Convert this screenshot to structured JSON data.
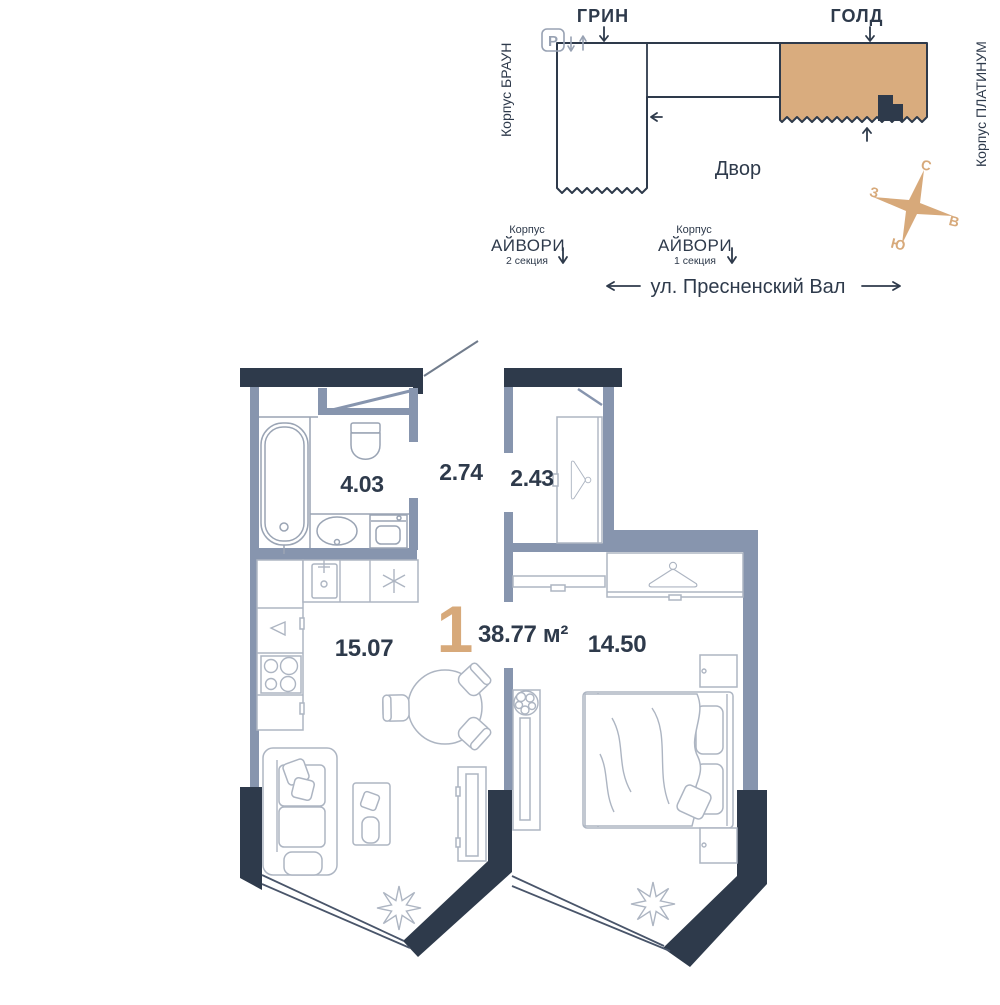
{
  "theme": {
    "wall_dark": "#2E3A4B",
    "wall_light": "#8795AE",
    "accent": "#D7A97A",
    "gold_fill": "#D9AC7E",
    "line_light": "#9AA4B4",
    "furniture": "#ADB5C2",
    "outline_gray": "#98A2B3",
    "glazing": "#49556A",
    "leader": "#717C8C"
  },
  "site_plan": {
    "labels": {
      "green": "ГРИН",
      "gold": "ГОЛД",
      "brown": "Корпус БРАУН",
      "platinum": "Корпус ПЛАТИНУМ",
      "ivory2_korpus": "Корпус",
      "ivory2_name": "АЙВОРИ",
      "ivory2_section": "2 секция",
      "ivory1_korpus": "Корпус",
      "ivory1_name": "АЙВОРИ",
      "ivory1_section": "1 секция",
      "courtyard": "Двор",
      "street": "ул. Пресненский Вал",
      "parking": "P"
    },
    "compass": {
      "north": "С",
      "west": "З",
      "east": "В",
      "south": "Ю"
    }
  },
  "floor_plan": {
    "summary": {
      "rooms": "1",
      "total_area": "38.77 м²"
    },
    "areas": {
      "bathroom": "4.03",
      "hallway": "2.74",
      "wardrobe": "2.43",
      "kitchen_living": "15.07",
      "bedroom": "14.50"
    }
  }
}
